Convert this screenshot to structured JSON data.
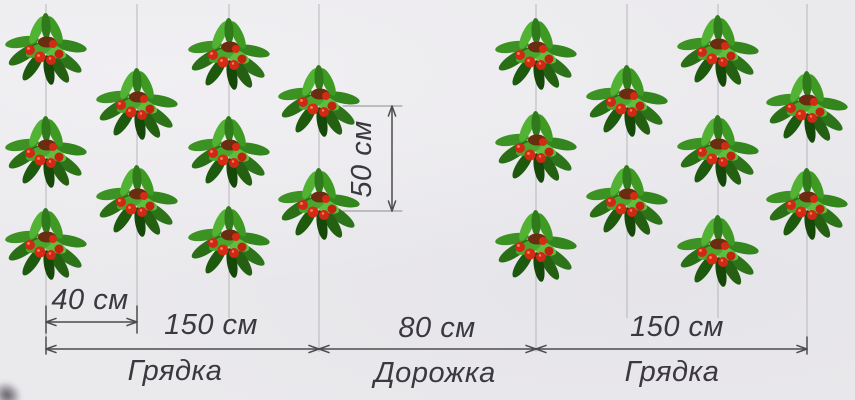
{
  "diagram": {
    "type": "strawberry-planting-scheme",
    "units": "см",
    "labels": {
      "row_spacing": "40 см",
      "plant_spacing": "50 см",
      "bed_width_left": "150 см",
      "bed_name_left": "Грядка",
      "path_width": "80 см",
      "path_name": "Дорожка",
      "bed_width_right": "150 см",
      "bed_name_right": "Грядка"
    },
    "colors": {
      "background": "#eae9ec",
      "row_line": "#b7b6ba",
      "dimension": "#4c4b50",
      "text": "#3a3940",
      "berry": "#cf2817"
    },
    "measurements_cm": {
      "between_rows": 40,
      "between_plants_in_row": 50,
      "bed_width": 150,
      "path_width": 80
    },
    "rows": [
      {
        "x": 46,
        "line_end": 348,
        "plants_y": [
          45,
          148,
          240
        ]
      },
      {
        "x": 137,
        "line_end": 333,
        "plants_y": [
          100,
          197
        ]
      },
      {
        "x": 229,
        "line_end": 318,
        "plants_y": [
          50,
          148,
          238
        ]
      },
      {
        "x": 319,
        "line_end": 352,
        "plants_y": [
          97,
          200
        ]
      },
      {
        "x": 536,
        "line_end": 352,
        "plants_y": [
          50,
          143,
          242
        ]
      },
      {
        "x": 627,
        "line_end": 318,
        "plants_y": [
          97,
          197
        ]
      },
      {
        "x": 718,
        "line_end": 318,
        "plants_y": [
          47,
          147,
          247
        ]
      },
      {
        "x": 807,
        "line_end": 348,
        "plants_y": [
          103,
          200
        ]
      }
    ],
    "dims": {
      "row_spacing": {
        "x1": 46,
        "x2": 137,
        "y": 322,
        "ext_top": 306,
        "ext_bottom": 333
      },
      "plant_spacing": {
        "x": 392,
        "y1": 106,
        "y2": 211,
        "tick_x1": 343,
        "tick_x2": 402
      },
      "chain_y": 349,
      "chain": [
        {
          "x1": 46,
          "x2": 319
        },
        {
          "x1": 319,
          "x2": 536
        },
        {
          "x1": 536,
          "x2": 807
        }
      ]
    }
  }
}
